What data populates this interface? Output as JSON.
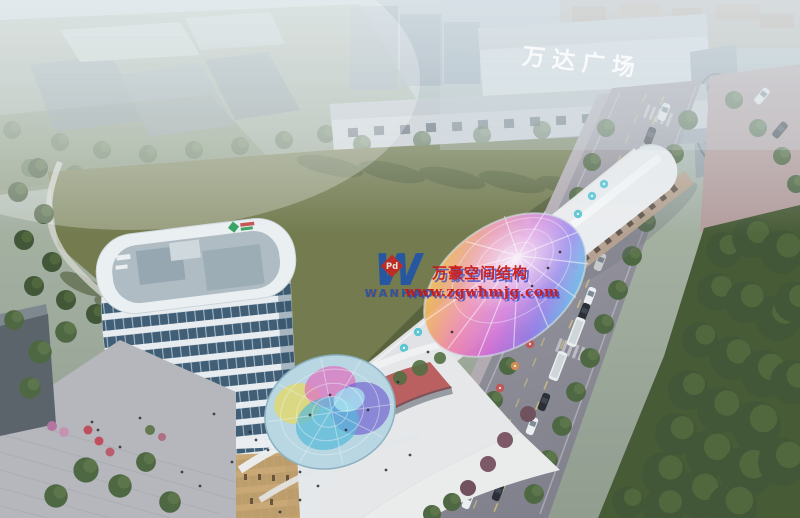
{
  "scene": {
    "mall_sign": {
      "text": "万达广场",
      "color": "#fafbfc"
    },
    "watermark": {
      "company": "万豪空间结构",
      "website": "www.zgwhmjg.com",
      "logo_letter": "W",
      "logo_badge": "Pd",
      "logo_name": "WANHAO",
      "text_color": "#c91414",
      "shadow_color": "#2b45c8",
      "logo_color": "#1e52ae",
      "badge_color": "#c92121"
    },
    "palette": {
      "haze": "#bdc9d1",
      "sky_fog": "#dfe7ec",
      "lawn": "#6f7748",
      "lawn_shadow": "#4c5733",
      "tree_green": "#49623d",
      "tree_dark": "#3c5130",
      "road_gray": "#8f8e99",
      "road_warm": "#b3a0a2",
      "tower_white": "#e9eef2",
      "tower_glass": "#3a5872",
      "retail_white": "#eceded",
      "accent_red": "#b64a4a",
      "umbrella_cyan": "#56c6d4",
      "canopy_rainbow": [
        "#f6ef6a",
        "#f2b052",
        "#ee7ca6",
        "#cf63d6",
        "#8a74ea",
        "#58c6ea",
        "#5ecf9a"
      ]
    }
  }
}
